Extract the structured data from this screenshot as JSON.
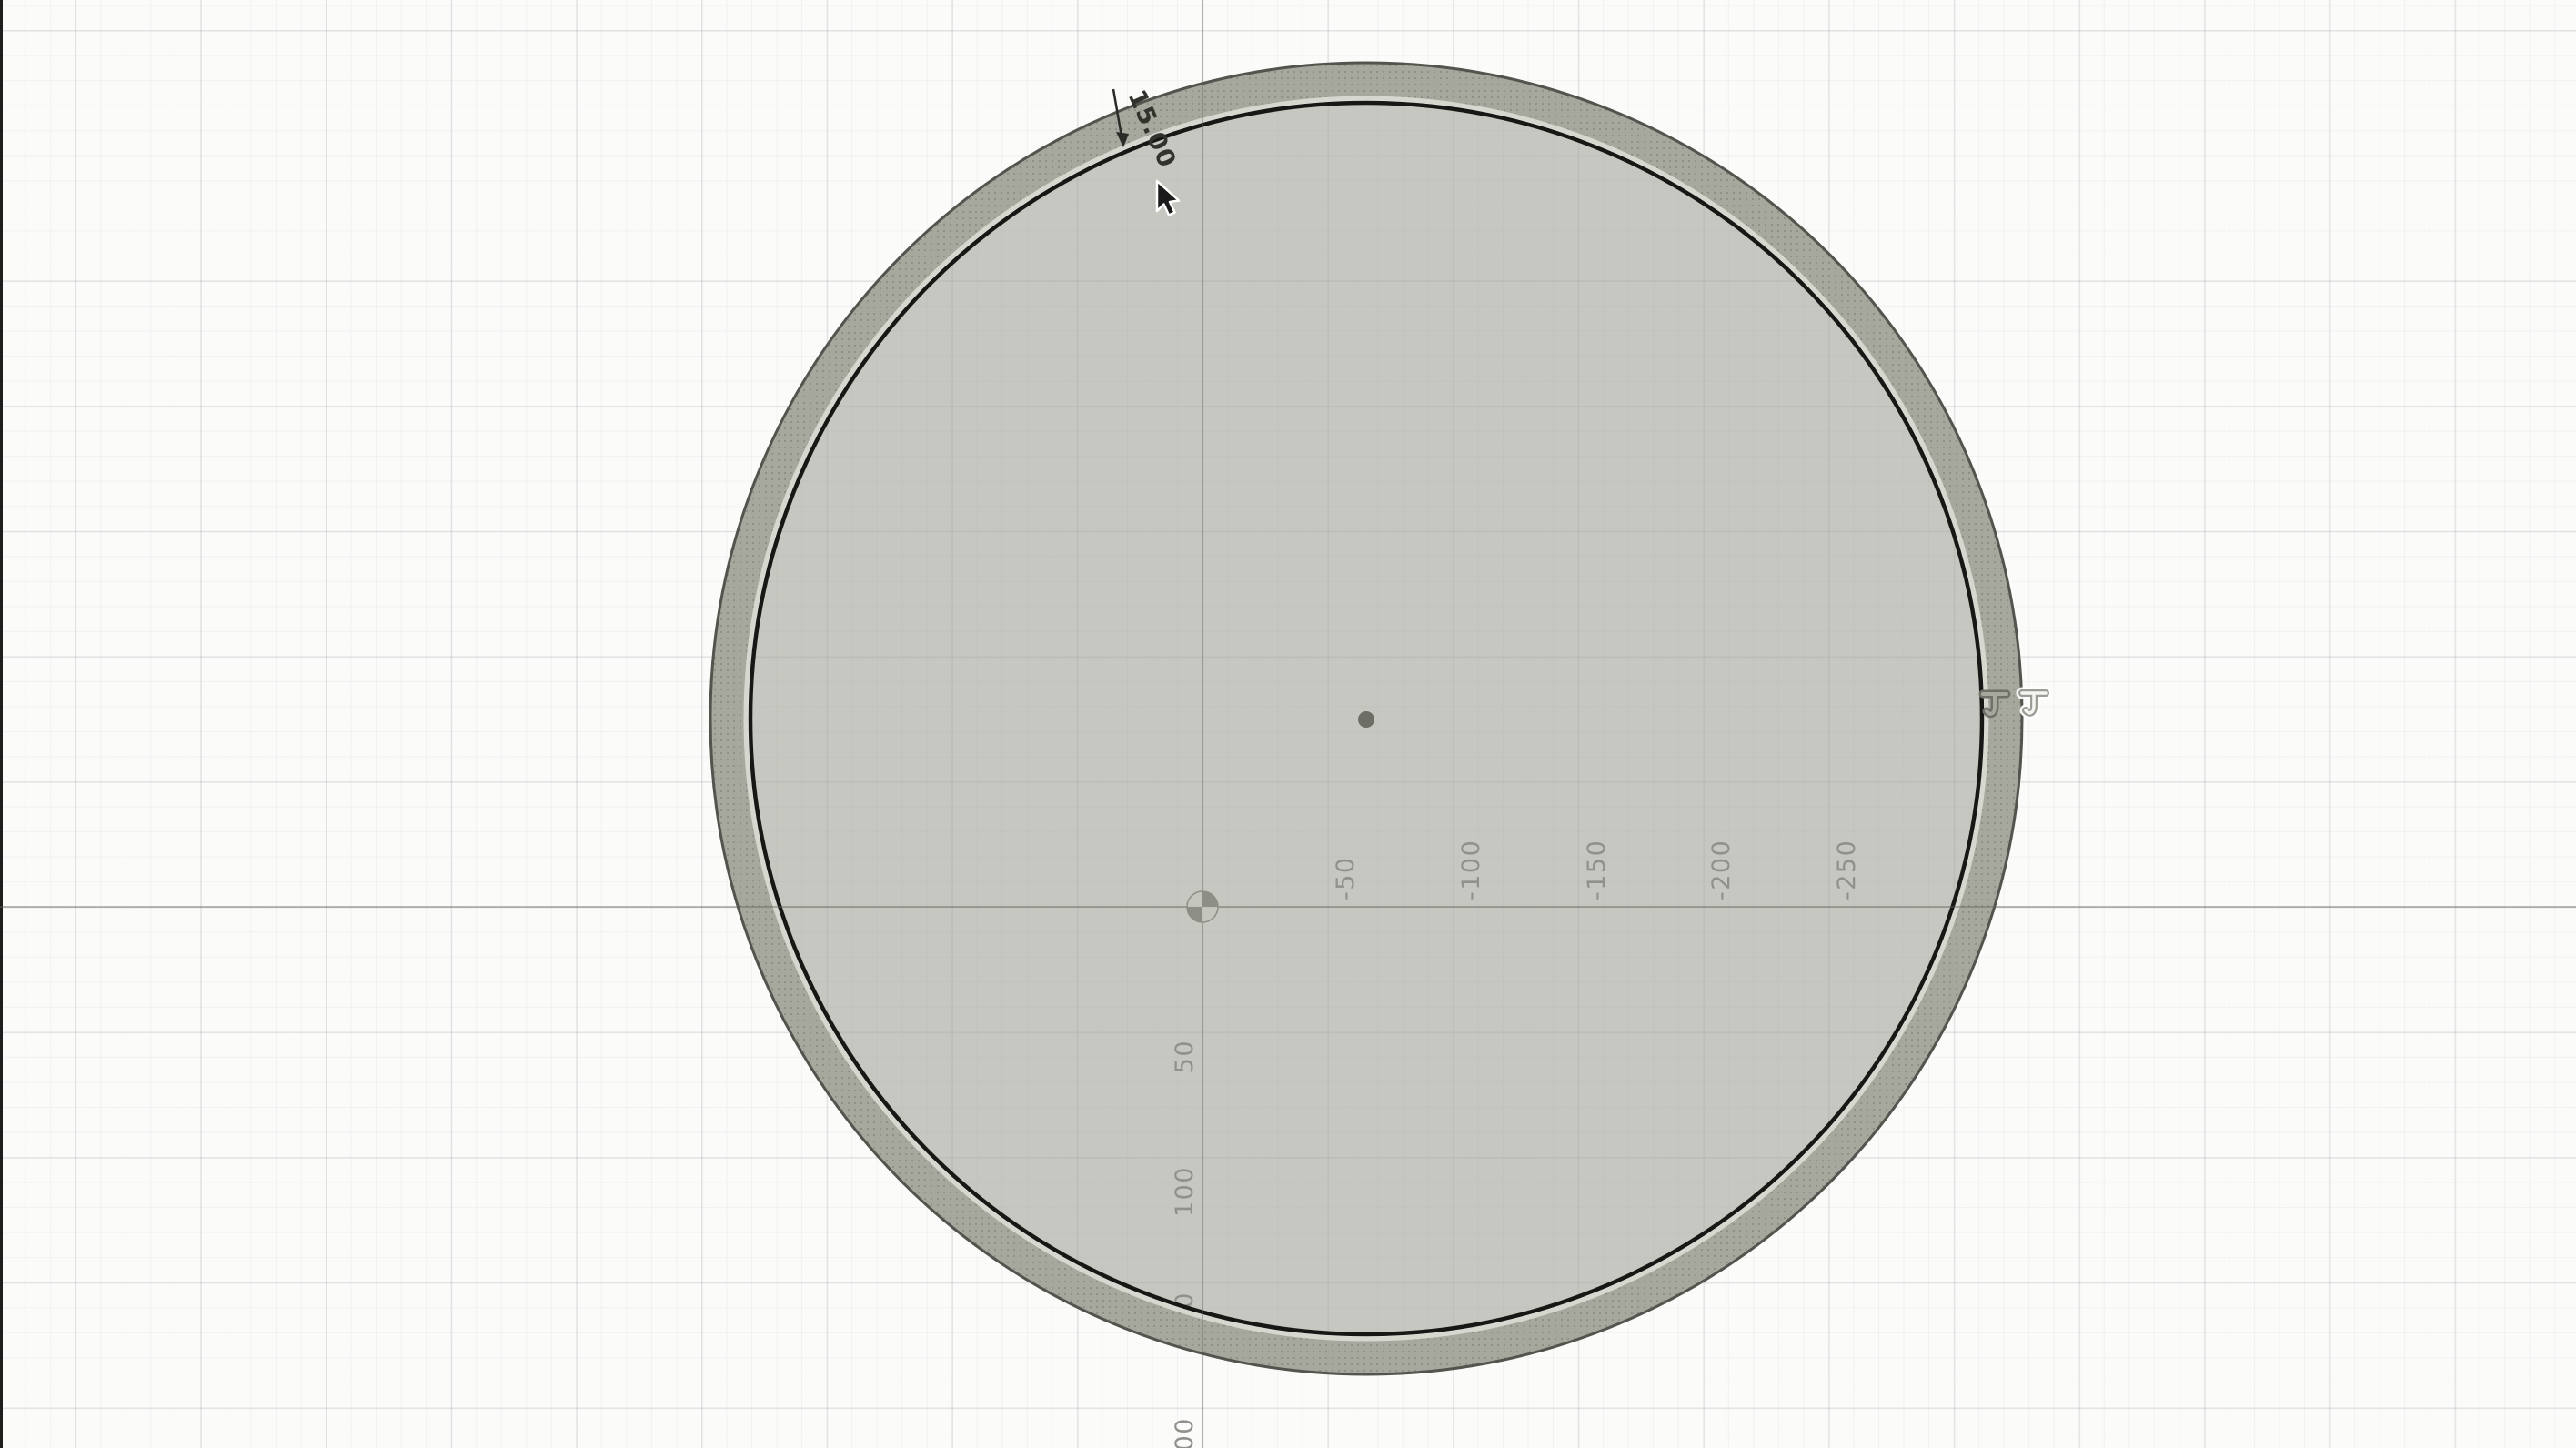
{
  "viewport": {
    "type": "cad-sketch-canvas",
    "x_axis_labels": [
      "-50",
      "-100",
      "-150",
      "-200",
      "-250"
    ],
    "y_axis_labels": [
      "50",
      "100",
      "150",
      "200"
    ],
    "dimension_value": "15.00",
    "constraint_badges": [
      "tangent-constraint",
      "tangent-constraint"
    ],
    "colors": {
      "background": "#fbfbfa",
      "grid_minor": "#f0f0f1",
      "grid_major": "#e3e3e5",
      "ring_fill": "#a6a79d",
      "ring_outer_stroke": "#53544d",
      "ring_light_band": "#d6d7cf",
      "sketch_curve_black": "#171715",
      "disc_fill": "#c5c6bf",
      "axis_line": "#b2b5ac",
      "tick_label": "#8f918a",
      "dimension_text": "#33332e"
    }
  }
}
